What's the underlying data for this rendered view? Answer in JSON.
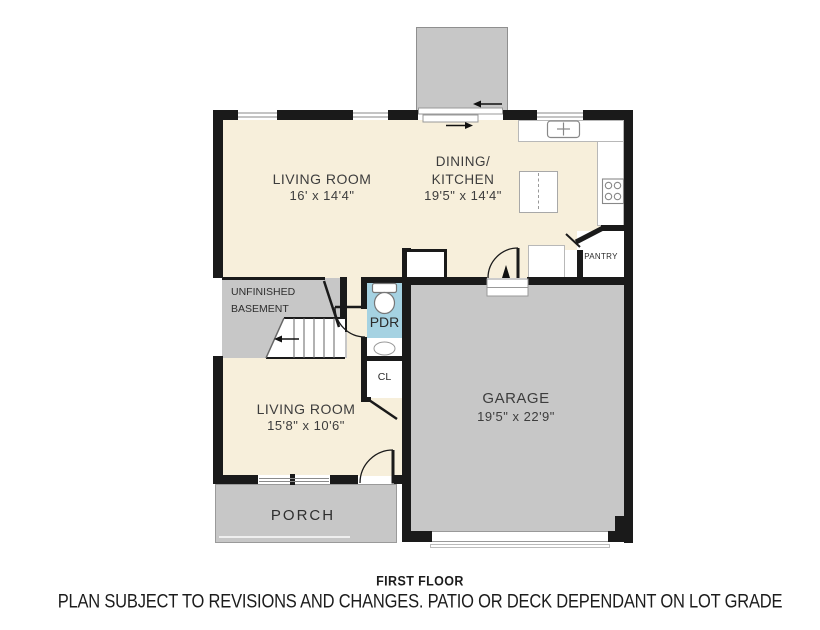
{
  "plan": {
    "rooms": [
      {
        "id": "living-room-upper",
        "label": "LIVING ROOM",
        "dims": "16' x 14'4\""
      },
      {
        "id": "dining-kitchen",
        "line1": "DINING/",
        "line2": "KITCHEN",
        "dims": "19'5\" x 14'4\""
      },
      {
        "id": "unfinished-basement",
        "line1": "UNFINISHED",
        "line2": "BASEMENT"
      },
      {
        "id": "powder-room",
        "label": "PDR"
      },
      {
        "id": "closet",
        "label": "CL"
      },
      {
        "id": "pantry",
        "label": "PANTRY"
      },
      {
        "id": "garage",
        "label": "GARAGE",
        "dims": "19'5\" x 22'9\""
      },
      {
        "id": "living-room-lower",
        "label": "LIVING ROOM",
        "dims": "15'8\" x 10'6\""
      },
      {
        "id": "porch",
        "label": "PORCH"
      }
    ],
    "captions": {
      "floor_label": "FIRST FLOOR",
      "disclaimer": "PLAN SUBJECT TO REVISIONS AND CHANGES. PATIO OR DECK DEPENDANT ON LOT GRADE"
    },
    "colors": {
      "interior_cream": "#f7efdb",
      "exterior_gray": "#c7c7c7",
      "pdr_blue": "#a5d2e2",
      "wall_black": "#1a1a1a",
      "label_text": "#3d3d3d"
    }
  }
}
